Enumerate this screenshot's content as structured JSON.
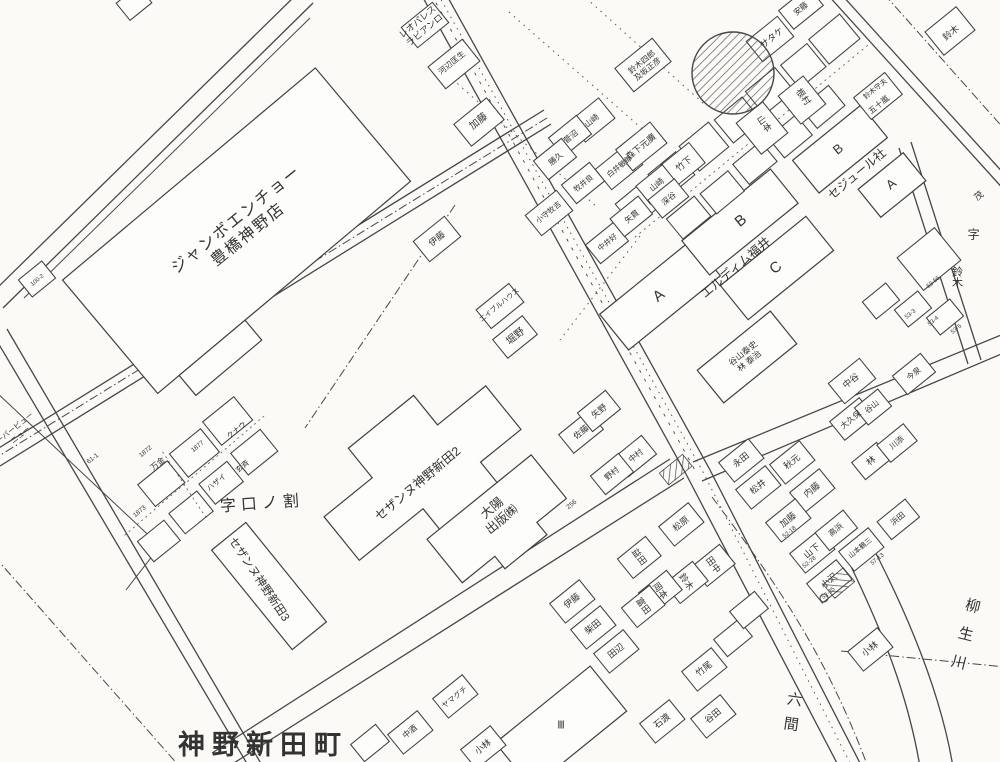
{
  "colors": {
    "paper": "#fbfaf7",
    "ink": "#474747",
    "label": "#333333"
  },
  "labels": [
    {
      "n": "store-label-jumbo-encho",
      "t": "ジャンボエンチョー\n豊橋神野店",
      "x": 243,
      "y": 228,
      "r": -39,
      "s": 16,
      "ls": 2
    },
    {
      "n": "area-label-kuchi-no-wari",
      "t": "字口ノ割",
      "x": 262,
      "y": 505,
      "r": -4,
      "s": 16,
      "ls": 5
    },
    {
      "n": "building-label-cezanne-2",
      "t": "セザンヌ神野新田2",
      "x": 418,
      "y": 484,
      "r": -40,
      "s": 12.5
    },
    {
      "n": "building-label-cezanne-3",
      "t": "セザンヌ神野新田3",
      "x": 258,
      "y": 580,
      "r": 56,
      "s": 11.5
    },
    {
      "n": "building-label-taiyo-shuppan",
      "t": "大陽\n出版㈱",
      "x": 497,
      "y": 514,
      "r": -40,
      "s": 12.5
    },
    {
      "n": "town-label-jinno-shinden-cho",
      "t": "神野新田町",
      "x": 263,
      "y": 746,
      "r": 0,
      "s": 27,
      "b": 1,
      "ls": 7
    },
    {
      "n": "building-label-eldim-fukui",
      "t": "エルディム福井",
      "x": 736,
      "y": 268,
      "r": -40,
      "s": 12.5
    },
    {
      "n": "building-label-sejour",
      "t": "セジュール社",
      "x": 857,
      "y": 174,
      "r": -40,
      "s": 12
    },
    {
      "n": "building-label-leopalace",
      "t": "レオパレス\nラビアンロ",
      "x": 421,
      "y": 26,
      "r": -40,
      "s": 9
    },
    {
      "n": "river-label-yagyugawa",
      "t": "柳生川",
      "x": 963,
      "y": 640,
      "r": 14,
      "s": 15,
      "v": 1,
      "ls": 14
    },
    {
      "n": "area-label-rokken",
      "t": "六間",
      "x": 791,
      "y": 716,
      "r": 8,
      "s": 15,
      "v": 1,
      "ls": 10
    },
    {
      "n": "aza-label",
      "t": "字",
      "x": 973,
      "y": 234,
      "s": 12,
      "v": 1
    },
    {
      "n": "house-name-label",
      "t": "鈴木",
      "x": 956,
      "y": 277,
      "s": 11,
      "v": 1
    },
    {
      "n": "house-name-label",
      "t": "茂",
      "x": 979,
      "y": 196,
      "r": -40,
      "s": 9
    },
    {
      "n": "building-letter-a",
      "t": "A",
      "x": 659,
      "y": 296,
      "r": -39,
      "s": 15
    },
    {
      "n": "building-letter-b",
      "t": "B",
      "x": 741,
      "y": 221,
      "r": -39,
      "s": 15
    },
    {
      "n": "building-letter-c",
      "t": "C",
      "x": 776,
      "y": 268,
      "r": -39,
      "s": 15
    },
    {
      "n": "building-letter-b",
      "t": "B",
      "x": 838,
      "y": 149,
      "r": -39,
      "s": 13
    },
    {
      "n": "building-letter-a",
      "t": "A",
      "x": 891,
      "y": 184,
      "r": -39,
      "s": 13
    },
    {
      "n": "building-mark",
      "t": "Ⅲ",
      "x": 561,
      "y": 726,
      "s": 11
    },
    {
      "n": "house-name-label",
      "t": "河辺匡生",
      "x": 452,
      "y": 63,
      "r": -39,
      "s": 8
    },
    {
      "n": "house-name-label",
      "t": "加藤",
      "x": 479,
      "y": 122,
      "r": -39,
      "s": 10
    },
    {
      "n": "house-name-label",
      "t": "鈴木四郎\n及坂正彦",
      "x": 645,
      "y": 66,
      "r": -39,
      "s": 8
    },
    {
      "n": "house-name-label",
      "t": "山崎",
      "x": 592,
      "y": 121,
      "r": -39,
      "s": 8
    },
    {
      "n": "house-name-label",
      "t": "菅沼",
      "x": 571,
      "y": 137,
      "r": -39,
      "s": 8
    },
    {
      "n": "house-name-label",
      "t": "勝久",
      "x": 556,
      "y": 159,
      "r": -39,
      "s": 8
    },
    {
      "n": "house-name-label",
      "t": "安藤",
      "x": 801,
      "y": 9,
      "r": -39,
      "s": 8
    },
    {
      "n": "house-name-label",
      "t": "サタケ",
      "x": 772,
      "y": 38,
      "r": -39,
      "s": 9
    },
    {
      "n": "house-name-label",
      "t": "山本",
      "x": 764,
      "y": 124,
      "r": 54,
      "s": 9
    },
    {
      "n": "house-name-label",
      "t": "根村",
      "x": 803,
      "y": 97,
      "r": 54,
      "s": 9
    },
    {
      "n": "house-name-label",
      "t": "鈴木守夫",
      "x": 876,
      "y": 90,
      "r": -39,
      "s": 7
    },
    {
      "n": "house-name-label",
      "t": "五十嵐",
      "x": 879,
      "y": 105,
      "r": -39,
      "s": 8
    },
    {
      "n": "house-name-label",
      "t": "鈴木",
      "x": 951,
      "y": 33,
      "r": -39,
      "s": 9
    },
    {
      "n": "house-name-label",
      "t": "森下元廣",
      "x": 641,
      "y": 147,
      "r": -39,
      "s": 9
    },
    {
      "n": "house-name-label",
      "t": "竹下",
      "x": 684,
      "y": 164,
      "r": -39,
      "s": 9
    },
    {
      "n": "house-name-label",
      "t": "山崎",
      "x": 657,
      "y": 185,
      "r": -39,
      "s": 8
    },
    {
      "n": "house-name-label",
      "t": "深谷",
      "x": 669,
      "y": 199,
      "r": -39,
      "s": 8
    },
    {
      "n": "house-name-label",
      "t": "矢貫",
      "x": 632,
      "y": 217,
      "r": -39,
      "s": 8
    },
    {
      "n": "house-name-label",
      "t": "伊藤",
      "x": 437,
      "y": 239,
      "r": -39,
      "s": 9
    },
    {
      "n": "house-name-label",
      "t": "小守牧吉",
      "x": 549,
      "y": 213,
      "r": -39,
      "s": 7.5
    },
    {
      "n": "house-name-label",
      "t": "白井敏郎",
      "x": 620,
      "y": 167,
      "r": -39,
      "s": 7.5
    },
    {
      "n": "house-name-label",
      "t": "牧井良",
      "x": 584,
      "y": 184,
      "r": -39,
      "s": 7.5
    },
    {
      "n": "house-name-label",
      "t": "中井好",
      "x": 608,
      "y": 243,
      "r": -39,
      "s": 7.5
    },
    {
      "n": "house-name-label",
      "t": "エイブルハウス",
      "x": 500,
      "y": 306,
      "r": -39,
      "s": 7
    },
    {
      "n": "house-name-label",
      "t": "堀野",
      "x": 516,
      "y": 337,
      "r": -39,
      "s": 10
    },
    {
      "n": "house-name-label",
      "t": "佐藤",
      "x": 581,
      "y": 432,
      "r": -39,
      "s": 8.5
    },
    {
      "n": "house-name-label",
      "t": "矢野",
      "x": 599,
      "y": 411,
      "r": -39,
      "s": 8.5
    },
    {
      "n": "house-name-label",
      "t": "中村",
      "x": 636,
      "y": 456,
      "r": -39,
      "s": 8
    },
    {
      "n": "house-name-label",
      "t": "野村",
      "x": 612,
      "y": 474,
      "r": -39,
      "s": 8
    },
    {
      "n": "house-name-label",
      "t": "谷山泰史\n林 泰治",
      "x": 746,
      "y": 357,
      "r": -39,
      "s": 8.5
    },
    {
      "n": "house-name-label",
      "t": "中谷",
      "x": 851,
      "y": 381,
      "r": -39,
      "s": 9
    },
    {
      "n": "house-name-label",
      "t": "大久保",
      "x": 851,
      "y": 420,
      "r": -39,
      "s": 8
    },
    {
      "n": "house-name-label",
      "t": "谷山",
      "x": 872,
      "y": 407,
      "r": -39,
      "s": 8
    },
    {
      "n": "house-name-label",
      "t": "今泉",
      "x": 914,
      "y": 374,
      "r": -39,
      "s": 8
    },
    {
      "n": "house-name-label",
      "t": "林",
      "x": 871,
      "y": 461,
      "r": -39,
      "s": 9
    },
    {
      "n": "house-name-label",
      "t": "川添",
      "x": 897,
      "y": 443,
      "r": -39,
      "s": 8
    },
    {
      "n": "house-name-label",
      "t": "永田",
      "x": 741,
      "y": 460,
      "r": -39,
      "s": 9
    },
    {
      "n": "house-name-label",
      "t": "秋元",
      "x": 792,
      "y": 462,
      "r": -39,
      "s": 9
    },
    {
      "n": "house-name-label",
      "t": "松井",
      "x": 758,
      "y": 487,
      "r": -39,
      "s": 9
    },
    {
      "n": "house-name-label",
      "t": "内藤",
      "x": 812,
      "y": 490,
      "r": -39,
      "s": 9
    },
    {
      "n": "house-name-label",
      "t": "加藤",
      "x": 788,
      "y": 520,
      "r": -39,
      "s": 9
    },
    {
      "n": "house-name-label",
      "t": "山下",
      "x": 812,
      "y": 551,
      "r": -39,
      "s": 9
    },
    {
      "n": "house-name-label",
      "t": "高浜",
      "x": 836,
      "y": 530,
      "r": -39,
      "s": 8
    },
    {
      "n": "house-name-label",
      "t": "浜田",
      "x": 898,
      "y": 519,
      "r": -39,
      "s": 8
    },
    {
      "n": "house-name-label",
      "t": "山本鶴三",
      "x": 861,
      "y": 549,
      "r": -39,
      "s": 7
    },
    {
      "n": "house-name-label",
      "t": "小沢",
      "x": 829,
      "y": 581,
      "r": -39,
      "s": 9
    },
    {
      "n": "house-name-label",
      "t": "小林",
      "x": 870,
      "y": 649,
      "r": -39,
      "s": 9
    },
    {
      "n": "house-name-label",
      "t": "松原",
      "x": 681,
      "y": 524,
      "r": -39,
      "s": 9
    },
    {
      "n": "house-name-label",
      "t": "益田",
      "x": 639,
      "y": 557,
      "r": 54,
      "s": 9
    },
    {
      "n": "house-name-label",
      "t": "田中",
      "x": 713,
      "y": 565,
      "r": 54,
      "s": 9
    },
    {
      "n": "house-name-label",
      "t": "鈴木",
      "x": 686,
      "y": 582,
      "r": 54,
      "s": 9
    },
    {
      "n": "house-name-label",
      "t": "岡本",
      "x": 660,
      "y": 591,
      "r": 54,
      "s": 9
    },
    {
      "n": "house-name-label",
      "t": "富田",
      "x": 643,
      "y": 606,
      "r": 54,
      "s": 9
    },
    {
      "n": "house-name-label",
      "t": "伊藤",
      "x": 572,
      "y": 601,
      "r": -39,
      "s": 9
    },
    {
      "n": "house-name-label",
      "t": "柴田",
      "x": 593,
      "y": 627,
      "r": -39,
      "s": 9
    },
    {
      "n": "house-name-label",
      "t": "田辺",
      "x": 616,
      "y": 651,
      "r": -39,
      "s": 9
    },
    {
      "n": "house-name-label",
      "t": "竹尾",
      "x": 704,
      "y": 669,
      "r": -39,
      "s": 9
    },
    {
      "n": "house-name-label",
      "t": "谷田",
      "x": 713,
      "y": 716,
      "r": -39,
      "s": 9
    },
    {
      "n": "house-name-label",
      "t": "石渡",
      "x": 662,
      "y": 721,
      "r": -39,
      "s": 9
    },
    {
      "n": "house-name-label",
      "t": "ヤマグチ",
      "x": 455,
      "y": 698,
      "r": -39,
      "s": 7.5
    },
    {
      "n": "house-name-label",
      "t": "中酒",
      "x": 410,
      "y": 732,
      "r": -39,
      "s": 8
    },
    {
      "n": "house-name-label",
      "t": "小林",
      "x": 483,
      "y": 747,
      "r": -39,
      "s": 9
    },
    {
      "n": "house-name-label",
      "t": "万金",
      "x": 158,
      "y": 464,
      "r": -39,
      "s": 8
    },
    {
      "n": "house-name-label",
      "t": "クナウ",
      "x": 237,
      "y": 431,
      "r": -39,
      "s": 7.5
    },
    {
      "n": "house-name-label",
      "t": "ハザイ",
      "x": 217,
      "y": 483,
      "r": -39,
      "s": 7.5
    },
    {
      "n": "house-name-label",
      "t": "玄斉",
      "x": 243,
      "y": 467,
      "r": -39,
      "s": 7.5
    },
    {
      "n": "edge-label-view",
      "t": "ーバービュー\nニュー",
      "x": 18,
      "y": 432,
      "r": -39,
      "s": 7.5
    },
    {
      "n": "lot-number",
      "t": "1872",
      "x": 146,
      "y": 452,
      "r": -39,
      "s": 6.5
    },
    {
      "n": "lot-number",
      "t": "1873",
      "x": 140,
      "y": 512,
      "r": -39,
      "s": 6.5
    },
    {
      "n": "lot-number",
      "t": "1877",
      "x": 198,
      "y": 447,
      "r": -39,
      "s": 6.5
    },
    {
      "n": "lot-number",
      "t": "61-1",
      "x": 93,
      "y": 459,
      "r": -39,
      "s": 6.5
    },
    {
      "n": "lot-number",
      "t": "256",
      "x": 572,
      "y": 505,
      "r": -39,
      "s": 6.5
    },
    {
      "n": "lot-number",
      "t": "52-18",
      "x": 790,
      "y": 533,
      "r": -39,
      "s": 6
    },
    {
      "n": "lot-number",
      "t": "52-28",
      "x": 810,
      "y": 563,
      "r": -39,
      "s": 6
    },
    {
      "n": "lot-number",
      "t": "52-25",
      "x": 829,
      "y": 594,
      "r": -39,
      "s": 6
    },
    {
      "n": "lot-number",
      "t": "57-13",
      "x": 878,
      "y": 560,
      "r": -39,
      "s": 6
    },
    {
      "n": "lot-number",
      "t": "53-55",
      "x": 934,
      "y": 283,
      "r": -39,
      "s": 6
    },
    {
      "n": "lot-number",
      "t": "53-3",
      "x": 911,
      "y": 315,
      "r": -39,
      "s": 6
    },
    {
      "n": "lot-number",
      "t": "53-4",
      "x": 934,
      "y": 322,
      "r": -39,
      "s": 6
    },
    {
      "n": "lot-number",
      "t": "53-5",
      "x": 957,
      "y": 330,
      "r": -39,
      "s": 6
    },
    {
      "n": "lot-number",
      "t": "100-2",
      "x": 38,
      "y": 281,
      "r": -39,
      "s": 6
    }
  ]
}
